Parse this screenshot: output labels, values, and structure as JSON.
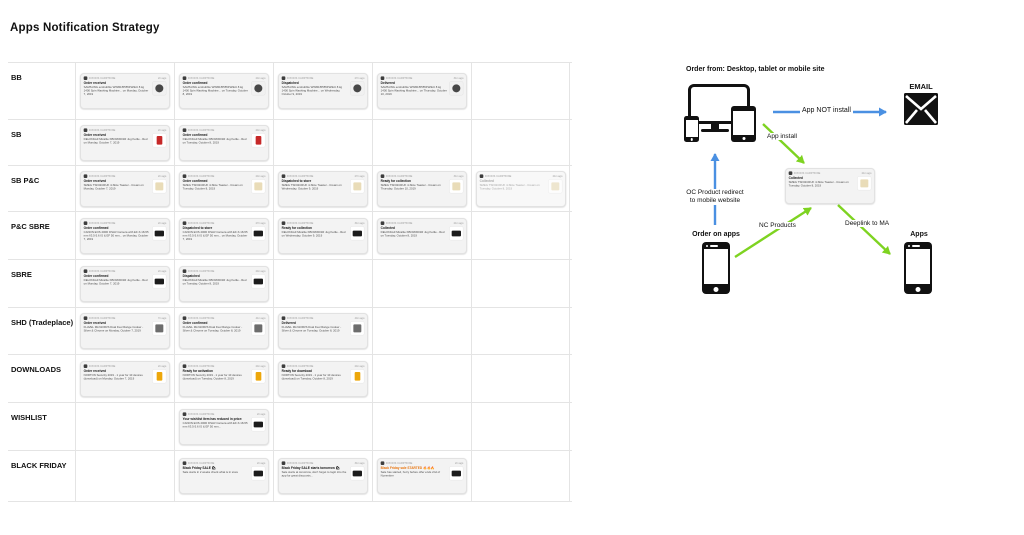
{
  "page": {
    "title": "Apps Notification Strategy"
  },
  "notification": {
    "app_name": "DIXONS CARPHONE"
  },
  "colors": {
    "arrow_blue": "#4a90e2",
    "arrow_green": "#7ed321",
    "card_bg": "#f3f3f3",
    "black_friday_orange": "#e8730c"
  },
  "thumbs": {
    "washer": {
      "bg": "#f1f1f1",
      "fg": "#474747",
      "shape": "circle"
    },
    "kettle": {
      "bg": "#ffffff",
      "fg": "#c62828",
      "shape": "rect-tall"
    },
    "toaster": {
      "bg": "#ffffff",
      "fg": "#e9dcb8",
      "shape": "square"
    },
    "camera": {
      "bg": "#ffffff",
      "fg": "#1c1c1c",
      "shape": "rect-wide"
    },
    "cooker": {
      "bg": "#ffffff",
      "fg": "#6d6d6d",
      "shape": "square"
    },
    "norton": {
      "bg": "#ffffff",
      "fg": "#eda70b",
      "shape": "rect-tall"
    }
  },
  "table": {
    "rows": [
      {
        "label": "BB",
        "height": 56,
        "cards": [
          {
            "col": 0,
            "time": "2m ago",
            "title": "Order received",
            "body": "SAMSUNG ecobubble WW80J5555FW/EU 8 kg 1400 Spin Washing Machine... on Monday, October 7, 2019",
            "thumb": "washer"
          },
          {
            "col": 1,
            "time": "24m ago",
            "title": "Order confirmed",
            "body": "SAMSUNG ecobubble WW80J5555FW/EU 8 kg 1400 Spin Washing Machine... on Tuesday, October 8, 2019",
            "thumb": "washer"
          },
          {
            "col": 2,
            "time": "27m ago",
            "title": "Dispatched",
            "body": "SAMSUNG ecobubble WW80J5555FW/EU 8 kg 1400 Spin Washing Machine... on Wednesday, October 9, 2019",
            "thumb": "washer"
          },
          {
            "col": 3,
            "time": "31m ago",
            "title": "Delivered",
            "body": "SAMSUNG ecobubble WW80J5555FW/EU 8 kg 1400 Spin Washing Machine... on Thursday, October 10, 2019",
            "thumb": "washer"
          }
        ]
      },
      {
        "label": "SB",
        "height": 45,
        "cards": [
          {
            "col": 0,
            "time": "2m ago",
            "title": "Order received",
            "body": "DELONGHI Micalite KBOM3001R Jug Kettle - Red on Monday, October 7, 2019",
            "thumb": "kettle"
          },
          {
            "col": 1,
            "time": "24m ago",
            "title": "Order confirmed",
            "body": "DELONGHI Micalite KBOM3001R Jug Kettle - Red on Tuesday, October 8, 2019",
            "thumb": "kettle"
          }
        ]
      },
      {
        "label": "SB P&C",
        "height": 45,
        "cards": [
          {
            "col": 0,
            "time": "2m ago",
            "title": "Order received",
            "body": "SMEG TSF02CRUK 4-Slice Toaster - Cream on Monday, October 7, 2019",
            "thumb": "toaster"
          },
          {
            "col": 1,
            "time": "24m ago",
            "title": "Order confirmed",
            "body": "SMEG TSF02CRUK 4-Slice Toaster - Cream on Tuesday, October 8, 2019",
            "thumb": "toaster"
          },
          {
            "col": 2,
            "time": "27m ago",
            "title": "Dispatched to store",
            "body": "SMEG TSF02CRUK 4-Slice Toaster - Cream on Wednesday, October 9, 2019",
            "thumb": "toaster"
          },
          {
            "col": 3,
            "time": "31m ago",
            "title": "Ready for collection",
            "body": "SMEG TSF02CRUK 4-Slice Toaster - Cream on Thursday, October 10, 2019",
            "thumb": "toaster"
          },
          {
            "col": 4,
            "time": "21m ago",
            "title": "Collected",
            "body": "SMEG TSF02CRUK 4-Slice Toaster - Cream on Tuesday, October 8, 2019",
            "thumb": "toaster",
            "muted": true
          }
        ]
      },
      {
        "label": "P&C SBRE",
        "height": 47,
        "cards": [
          {
            "col": 0,
            "time": "2m ago",
            "title": "Order confirmed",
            "body": "CANON EOS 200D DSLR Camera with EF-S 18-55 mm f/3.5-5.6 IS & EF 50 mm... on Monday, October 7, 2019",
            "thumb": "camera"
          },
          {
            "col": 1,
            "time": "27m ago",
            "title": "Dispatched to store",
            "body": "CANON EOS 200D DSLR Camera with EF-S 18-55 mm f/3.5-5.6 IS & EF 50 mm... on Monday, October 7, 2019",
            "thumb": "camera"
          },
          {
            "col": 2,
            "time": "31m ago",
            "title": "Ready for collection",
            "body": "DELONGHI Micalite KBOM3001R Jug Kettle - Red on Wednesday, October 9, 2019",
            "thumb": "camera"
          },
          {
            "col": 3,
            "time": "21m ago",
            "title": "Collected",
            "body": "DELONGHI Micalite KBOM3001R Jug Kettle - Red on Tuesday, October 8, 2019",
            "thumb": "camera"
          }
        ]
      },
      {
        "label": "SBRE",
        "height": 47,
        "cards": [
          {
            "col": 0,
            "time": "2m ago",
            "title": "Order confirmed",
            "body": "DELONGHI Micalite KBOM3001R Jug Kettle - Red on Monday, October 7, 2019",
            "thumb": "camera"
          },
          {
            "col": 1,
            "time": "24m ago",
            "title": "Dispatched",
            "body": "DELONGHI Micalite KBOM3001R Jug Kettle - Red on Tuesday, October 8, 2019",
            "thumb": "camera"
          }
        ]
      },
      {
        "label": "SHD (Tradeplace)",
        "height": 46,
        "cards": [
          {
            "col": 0,
            "time": "7m ago",
            "title": "Order received",
            "body": "FLAVEL MLN10FRS Dual Fuel Range Cooker - Silver & Chrome on Monday, October 7, 2019",
            "thumb": "cooker"
          },
          {
            "col": 1,
            "time": "41m ago",
            "title": "Order confirmed",
            "body": "FLAVEL MLN10FRS Dual Fuel Range Cooker - Silver & Chrome on Tuesday, October 8, 2019",
            "thumb": "cooker"
          },
          {
            "col": 2,
            "time": "44m ago",
            "title": "Delivered",
            "body": "FLAVEL MLN10FRS Dual Fuel Range Cooker - Silver & Chrome on Tuesday, October 8, 2019",
            "thumb": "cooker"
          }
        ]
      },
      {
        "label": "DOWNLOADS",
        "height": 47,
        "cards": [
          {
            "col": 0,
            "time": "2m ago",
            "title": "Order received",
            "body": "NORTON Security 2019 - 1 year for 10 devices (download) on Monday, October 7, 2019",
            "thumb": "norton"
          },
          {
            "col": 1,
            "time": "24m ago",
            "title": "Ready for activation",
            "body": "NORTON Security 2019 - 1 year for 10 devices (download) on Tuesday, October 8, 2019",
            "thumb": "norton"
          },
          {
            "col": 2,
            "time": "24m ago",
            "title": "Ready for download",
            "body": "NORTON Security 2019 - 1 year for 10 devices (download) on Tuesday, October 8, 2019",
            "thumb": "norton"
          }
        ]
      },
      {
        "label": "WISHLIST",
        "height": 47,
        "cards": [
          {
            "col": 1,
            "time": "2m ago",
            "title": "Your wishlist item has reduced in price:",
            "body": "CANON EOS 200D DSLR Camera with EF-S 18-55 mm f/3.5-5.6 IS & EF 50 mm...",
            "thumb": "camera"
          }
        ]
      },
      {
        "label": "BLACK FRIDAY",
        "height": 50,
        "cards": [
          {
            "col": 1,
            "time": "2m ago",
            "title": "Black Friday SALE 🛍",
            "body": "Sale starts in 2 weeks check what is in store",
            "thumb": "camera"
          },
          {
            "col": 2,
            "time": "31m ago",
            "title": "Black Friday SALE starts tomorrow 🛍",
            "body": "Sale starts at tomorrow, don't forget to login into the app for great discounts...",
            "thumb": "camera"
          },
          {
            "col": 3,
            "time": "2m ago",
            "title": "Black Friday sale STARTED 🔥🔥🔥",
            "body": "Sale has started, hurry before offer ends 2nd of November",
            "thumb": "camera",
            "title_color": "#e8730c"
          }
        ]
      }
    ]
  },
  "diagram": {
    "title": "Order from: Desktop, tablet or mobile site",
    "email_label": "EMAIL",
    "order_on_apps_label": "Order on apps",
    "apps_label": "Apps",
    "arrows": {
      "app_not_install": "App NOT install",
      "app_install": "App install",
      "oc_redirect_line1": "OC Product redirect",
      "oc_redirect_line2": "to mobile website",
      "nc_products": "NC Products",
      "deeplink": "Deeplink to MA"
    },
    "card": {
      "time": "21m ago",
      "title": "Collected",
      "body": "SMEG TSF02CRUK 4-Slice Toaster - Cream on Tuesday, October 8, 2019",
      "thumb": "toaster"
    }
  }
}
